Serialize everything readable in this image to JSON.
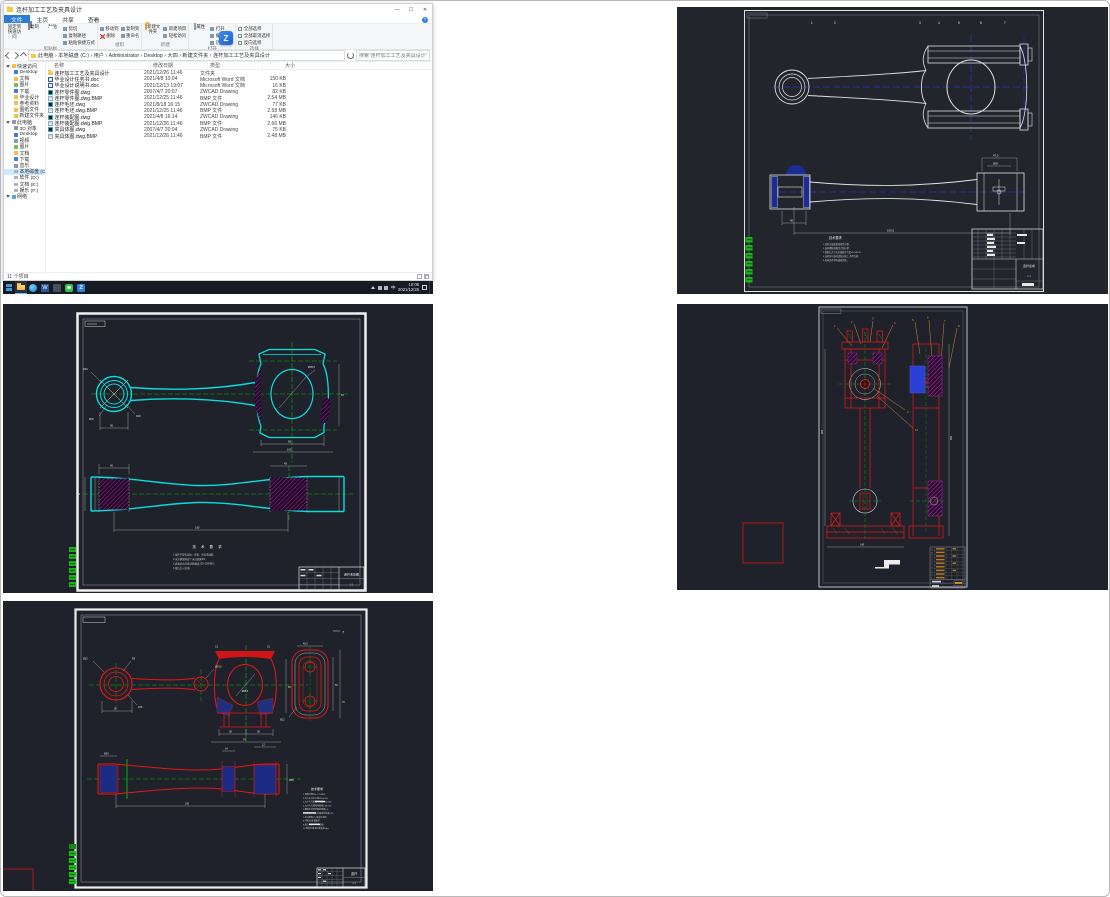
{
  "explorer": {
    "title": "连杆加工工艺及夹具设计",
    "controls": {
      "min": "—",
      "max": "☐",
      "close": "✕"
    },
    "tabs": {
      "file": "文件",
      "home": "主页",
      "share": "共享",
      "view": "查看"
    },
    "ribbon": {
      "help": "?",
      "pin": "固定到快速访问",
      "copy": "复制",
      "paste": "粘贴",
      "cut": "剪切",
      "copy_path": "复制路径",
      "paste_shortcut": "粘贴快捷方式",
      "move_to": "移动到",
      "copy_to": "复制到",
      "delete": "删除",
      "rename": "重命名",
      "new_folder": "新建文件夹",
      "new_item": "新建项目",
      "easy_access": "轻松访问",
      "properties": "属性",
      "open": "打开",
      "edit": "编辑",
      "history": "历史记录",
      "select_all": "全部选择",
      "select_none": "全部取消选择",
      "invert": "反向选择",
      "groups": [
        "剪贴板",
        "组织",
        "新建",
        "打开",
        "选择"
      ]
    },
    "address": {
      "breadcrumb": "此电脑 › 本地磁盘 (C:) › 用户 › Administrator › Desktop › 大四 › 新建文件夹 › 连杆加工工艺及夹具设计",
      "search_placeholder": "搜索“连杆加工工艺及夹具设计”"
    },
    "columns": {
      "name": "名称",
      "date": "修改日期",
      "type": "类型",
      "size": "大小"
    },
    "files": [
      {
        "icon": "folder",
        "name": "连杆加工工艺及夹具设计",
        "date": "2021/12/26 11:46",
        "type": "文件夹",
        "size": ""
      },
      {
        "icon": "word",
        "name": "毕业设计任务书.doc",
        "date": "2021/4/8 10:04",
        "type": "Microsoft Word 文档",
        "size": "150 KB"
      },
      {
        "icon": "word",
        "name": "毕业设计说明书.doc",
        "date": "2021/12/13 19:07",
        "type": "Microsoft Word 文档",
        "size": "16 KB"
      },
      {
        "icon": "dwg",
        "name": "连杆零件图.dwg",
        "date": "2007/4/7 20:07",
        "type": "ZWCAD Drawing",
        "size": "82 KB"
      },
      {
        "icon": "bmp",
        "name": "连杆零件图.dwg.BMP",
        "date": "2021/12/25 11:46",
        "type": "BMP 文件",
        "size": "2.54 MB"
      },
      {
        "icon": "dwg",
        "name": "连杆毛坯.dwg",
        "date": "2021/8/18 16:15",
        "type": "ZWCAD Drawing",
        "size": "77 KB"
      },
      {
        "icon": "bmp",
        "name": "连杆毛坯.dwg.BMP",
        "date": "2021/12/25 11:46",
        "type": "BMP 文件",
        "size": "2.58 MB"
      },
      {
        "icon": "dwg",
        "name": "连杆装配图.dwg",
        "date": "2021/4/8 16:14",
        "type": "ZWCAD Drawing",
        "size": "146 KB"
      },
      {
        "icon": "bmp",
        "name": "连杆装配图.dwg.BMP",
        "date": "2021/12/26 11:46",
        "type": "BMP 文件",
        "size": "2.66 MB"
      },
      {
        "icon": "dwg",
        "name": "夹具体图.dwg",
        "date": "2007/4/7 20:04",
        "type": "ZWCAD Drawing",
        "size": "75 KB"
      },
      {
        "icon": "bmp",
        "name": "夹具体图.dwg.BMP",
        "date": "2021/12/26 11:46",
        "type": "BMP 文件",
        "size": "2.48 MB"
      }
    ],
    "sidebar": {
      "quick_label": "快速访问",
      "quick": [
        {
          "label": "Desktop"
        },
        {
          "label": "文档"
        },
        {
          "label": "图片"
        },
        {
          "label": "下载"
        },
        {
          "label": "毕业设计"
        },
        {
          "label": "参考资料"
        },
        {
          "label": "图纸文件"
        },
        {
          "label": "新建文件夹"
        }
      ],
      "pc_label": "此电脑",
      "pc": [
        {
          "label": "3D 对象"
        },
        {
          "label": "Desktop"
        },
        {
          "label": "视频"
        },
        {
          "label": "图片"
        },
        {
          "label": "文档"
        },
        {
          "label": "下载"
        },
        {
          "label": "音乐"
        },
        {
          "label": "本地磁盘 (C:)"
        },
        {
          "label": "软件 (D:)"
        },
        {
          "label": "文档 (E:)"
        },
        {
          "label": "娱乐 (F:)"
        }
      ],
      "network_label": "网络"
    },
    "status": {
      "items": "11 个项目"
    },
    "taskbar": {
      "time": "10:08",
      "date": "2021/12/26",
      "lang": "中",
      "zw": "Z",
      "word": "W"
    }
  },
  "tr": {
    "balloons": [
      "1",
      "2",
      "3",
      "4",
      "5",
      "6",
      "7"
    ],
    "tech_title": "技术要求",
    "tech_lines": [
      "1.连杆总成质量按规定分组;",
      "2.连杆螺栓按规定力矩拧紧;",
      "3.装配后大小头孔轴线平行度≤0.04/100;",
      "4.连杆体与连杆盖配对加工,不得互换;",
      "5.各表面不得有磕碰划伤。"
    ],
    "dims": [
      "47.5",
      "Ø39",
      "40",
      "190.5"
    ],
    "title_label": "连杆总成",
    "title_scale": "1:1"
  },
  "ml": {
    "dims": [
      "R26",
      "R18",
      "Ø36",
      "Ø65.5",
      "36",
      "66",
      "102",
      "62",
      "40",
      "45",
      "190",
      "34"
    ],
    "tech_title": "技 术 要 求",
    "tech_lines": [
      "1.锻件不得有裂纹、折叠、夹层等缺陷;",
      "2.未注模锻斜度7°,未注圆角R3;",
      "3.表面喷丸处理,调质硬度229~269HBS;",
      "4.锻后正火处理。"
    ],
    "title_label": "连杆毛坯图",
    "title_scale": "1:1"
  },
  "mr": {
    "balloons": [
      "1",
      "2",
      "3",
      "4",
      "5",
      "6",
      "7",
      "8",
      "9",
      "10"
    ],
    "bom_index": [
      "9",
      "8",
      "7",
      "6",
      "5",
      "4",
      "3",
      "2",
      "1"
    ],
    "dims": [
      "265",
      "140",
      "280"
    ]
  },
  "bl": {
    "corner_label": "7",
    "dims": [
      "Ø25",
      "R16",
      "R5",
      "38",
      "Ø14.5",
      "C1",
      "Ø65.5",
      "38",
      "38",
      "76",
      "95",
      "46.5",
      "58",
      "70",
      "Ø12",
      "Ø24",
      "24",
      "12",
      "190",
      "Ø38"
    ],
    "notes_title": "技术要求",
    "notes_lines": [
      "1.调质处理226~271HBS;",
      "2.大小头孔中心距190±0.05;",
      "3.大小头孔轴线平行度0.04/100;",
      "4.大小头孔轴线扭曲度0.06/100;",
      "5.螺栓孔对结合面垂直度0.1;",
      "6.结合面对大头孔轴线对称度0.25;",
      "7.未注倒角C1,锐边去毛刺;",
      "8.材料45钢,模锻件;",
      "9.磁力探伤,不得有裂纹;",
      "10.称重分组,组内质量差≤8g。"
    ],
    "title_label": "连杆",
    "title_scale": "1:1"
  }
}
